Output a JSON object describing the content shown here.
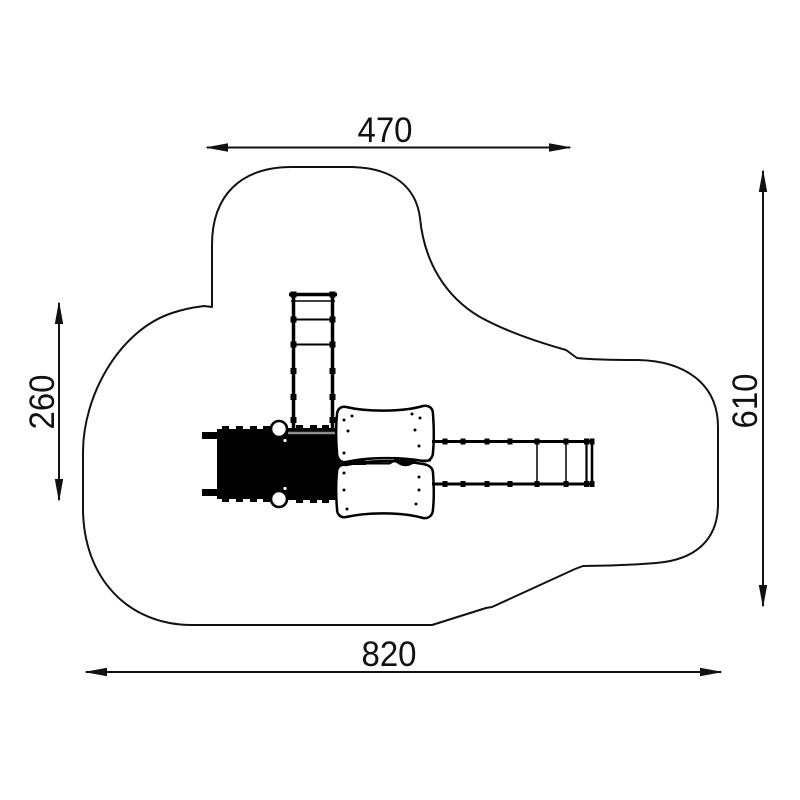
{
  "dimensions": {
    "top": {
      "label": "470"
    },
    "bottom": {
      "label": "820"
    },
    "left": {
      "label": "260"
    },
    "right": {
      "label": "610"
    }
  },
  "colors": {
    "line": "#111111",
    "background": "#ffffff",
    "equipment_fill": "#000000",
    "slide_edge_highlight": "#8f8f8f"
  },
  "components": {
    "outline": "safety-zone-outline",
    "ladder": "climbing-ladder",
    "slide": "slide-black-platform",
    "posts": "support-posts",
    "deck": "wavy-deck-platform",
    "bridge": "monkey-bar-bridge"
  }
}
